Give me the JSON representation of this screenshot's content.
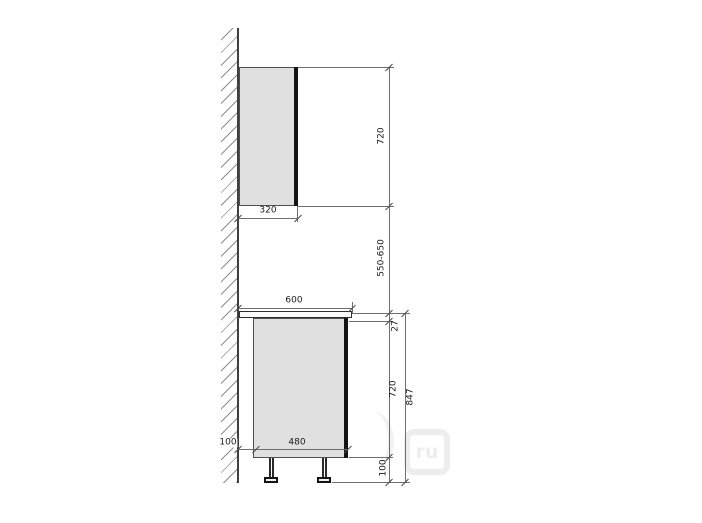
{
  "dims": {
    "wall_cabinet_height": "720",
    "wall_cabinet_depth": "320",
    "wall_cabinet_to_countertop": "550-650",
    "countertop_depth": "600",
    "countertop_thickness": "27",
    "base_cabinet_height": "720",
    "base_leg_height": "100",
    "base_total_height": "847",
    "wall_to_base_gap": "100",
    "base_body_depth": "480"
  },
  "watermark": {
    "badge_text": "ru"
  },
  "colors": {
    "cabinet_fill": "#e0e0e0",
    "door": "#141414",
    "outline": "#4f4f4f",
    "dim_line": "#6e6e6e",
    "text": "#1a1a1a",
    "background": "#ffffff"
  }
}
